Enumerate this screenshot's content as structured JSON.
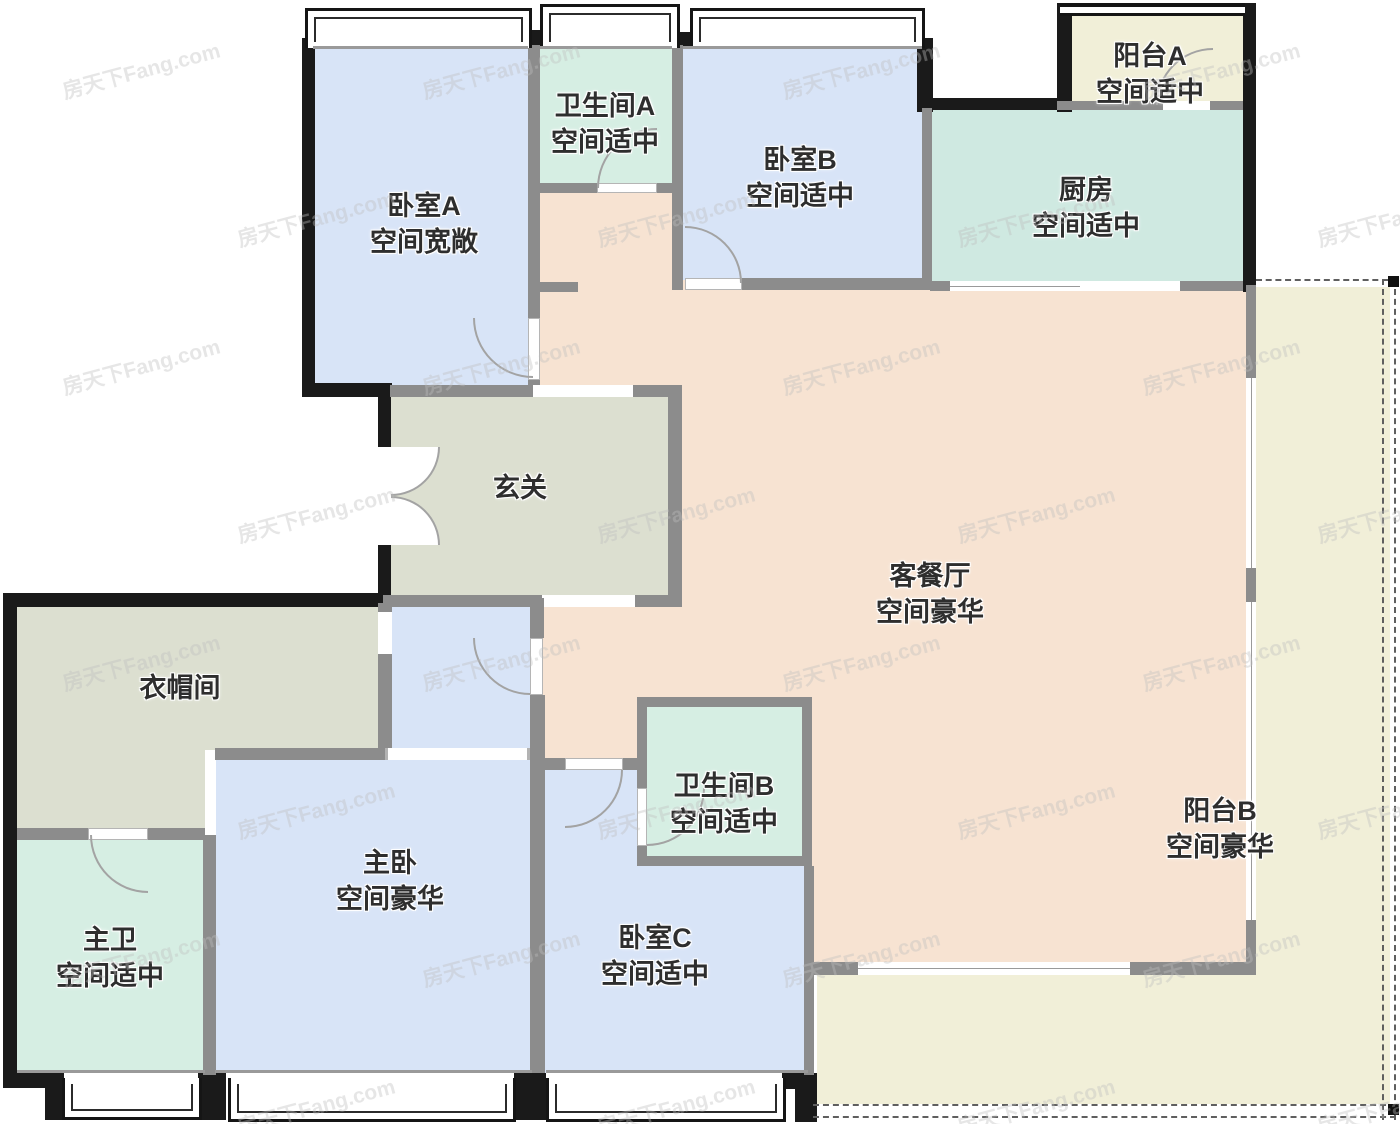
{
  "floor_plan": {
    "watermark": "房天下Fang.com",
    "rooms": [
      {
        "id": "bedroom-a",
        "name": "卧室A",
        "desc": "空间宽敞"
      },
      {
        "id": "bathroom-a",
        "name": "卫生间A",
        "desc": "空间适中"
      },
      {
        "id": "bedroom-b",
        "name": "卧室B",
        "desc": "空间适中"
      },
      {
        "id": "kitchen",
        "name": "厨房",
        "desc": "空间适中"
      },
      {
        "id": "balcony-a",
        "name": "阳台A",
        "desc": "空间适中"
      },
      {
        "id": "foyer",
        "name": "玄关",
        "desc": ""
      },
      {
        "id": "living-dining",
        "name": "客餐厅",
        "desc": "空间豪华"
      },
      {
        "id": "cloakroom",
        "name": "衣帽间",
        "desc": ""
      },
      {
        "id": "master-bath",
        "name": "主卫",
        "desc": "空间适中"
      },
      {
        "id": "master-bedroom",
        "name": "主卧",
        "desc": "空间豪华"
      },
      {
        "id": "bathroom-b",
        "name": "卫生间B",
        "desc": "空间适中"
      },
      {
        "id": "bedroom-c",
        "name": "卧室C",
        "desc": "空间适中"
      },
      {
        "id": "balcony-b",
        "name": "阳台B",
        "desc": "空间豪华"
      }
    ],
    "colors": {
      "bedroom": "#d8e4f7",
      "bathroom": "#d6eee3",
      "kitchen": "#cfe9e1",
      "utility": "#dcdfd0",
      "living": "#f7e3d2",
      "balcony": "#f1efd8",
      "wall_dark": "#1a1a1a",
      "wall_gray": "#8c8c8c"
    }
  }
}
